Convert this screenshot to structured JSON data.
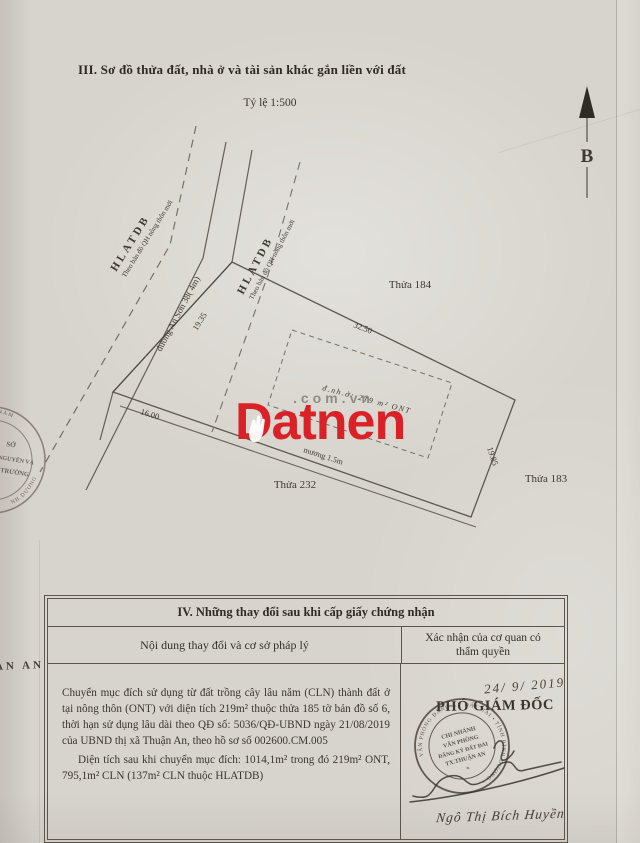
{
  "doc": {
    "section3_title": "III. Sơ đồ thửa đất, nhà ở và tài sản khác gắn liền với đất",
    "scale": "Tỷ lệ 1:500",
    "north": "B",
    "margin_fragment": "AN AN"
  },
  "watermark": {
    "brand": "Datnen",
    "suffix": ".com.vn",
    "red": "#da2127",
    "gray": "#8d8c88"
  },
  "diagram": {
    "road_name": "đường An Sơn 38( 4m)",
    "corridor": "HLATDB",
    "corridor_note": "Theo bản đồ QH nông thôn mới",
    "dim_frontage": "19.35",
    "dim_top": "32.50",
    "dim_right": "19.85",
    "dim_bottom_left": "16.00",
    "ditch": "mương 1.5m",
    "house_note": "đ.nh.ở: 219 m² ONT",
    "parcel_north": "Thửa 184",
    "parcel_east": "Thửa 183",
    "parcel_southwest": "Thửa 232"
  },
  "left_stamp": {
    "arc_top": "HCN VIỆT NAM",
    "line1": "SỞ",
    "line2": "NGUYÊN VÀ",
    "line3": "TRƯỜNG",
    "arc_bottom": "NH DƯƠNG"
  },
  "section4": {
    "title": "IV. Những thay đổi sau khi cấp giấy chứng nhận",
    "col_content": "Nội dung thay đổi và cơ sở pháp lý",
    "col_confirm": "Xác nhận của cơ quan có thẩm quyền",
    "para1": "Chuyển mục đích sử dụng từ đất trồng cây lâu năm (CLN) thành đất ở tại nông thôn (ONT) với diện tích 219m² thuộc thửa 185 tờ bản đồ số 6, thời hạn sử dụng lâu dài theo QĐ số: 5036/QĐ-UBND ngày 21/08/2019 của UBND thị xã Thuận An, theo hồ sơ số 002600.CM.005",
    "para2": "Diện tích sau khi chuyển mục đích: 1014,1m² trong đó 219m² ONT, 795,1m² CLN (137m² CLN thuộc HLATDB)",
    "confirm": {
      "date": "24/ 9/ 2019",
      "title": "PHÓ GIÁM ĐỐC",
      "stamp_ring": "VĂN PHÒNG ĐĂNG KÝ ĐẤT ĐAI • TỈNH BÌNH DƯƠNG •",
      "stamp_l1": "CHI NHÁNH",
      "stamp_l2": "VĂN PHÒNG",
      "stamp_l3": "ĐĂNG KÝ ĐẤT ĐAI",
      "stamp_l4": "TX.THUẬN AN",
      "signer": "Ngô Thị Bích Huyền"
    }
  },
  "colors": {
    "paper": "#d7d4cd",
    "ink": "#37332b",
    "stamp_ink": "#483f36",
    "watermark_red": "#da2127"
  }
}
